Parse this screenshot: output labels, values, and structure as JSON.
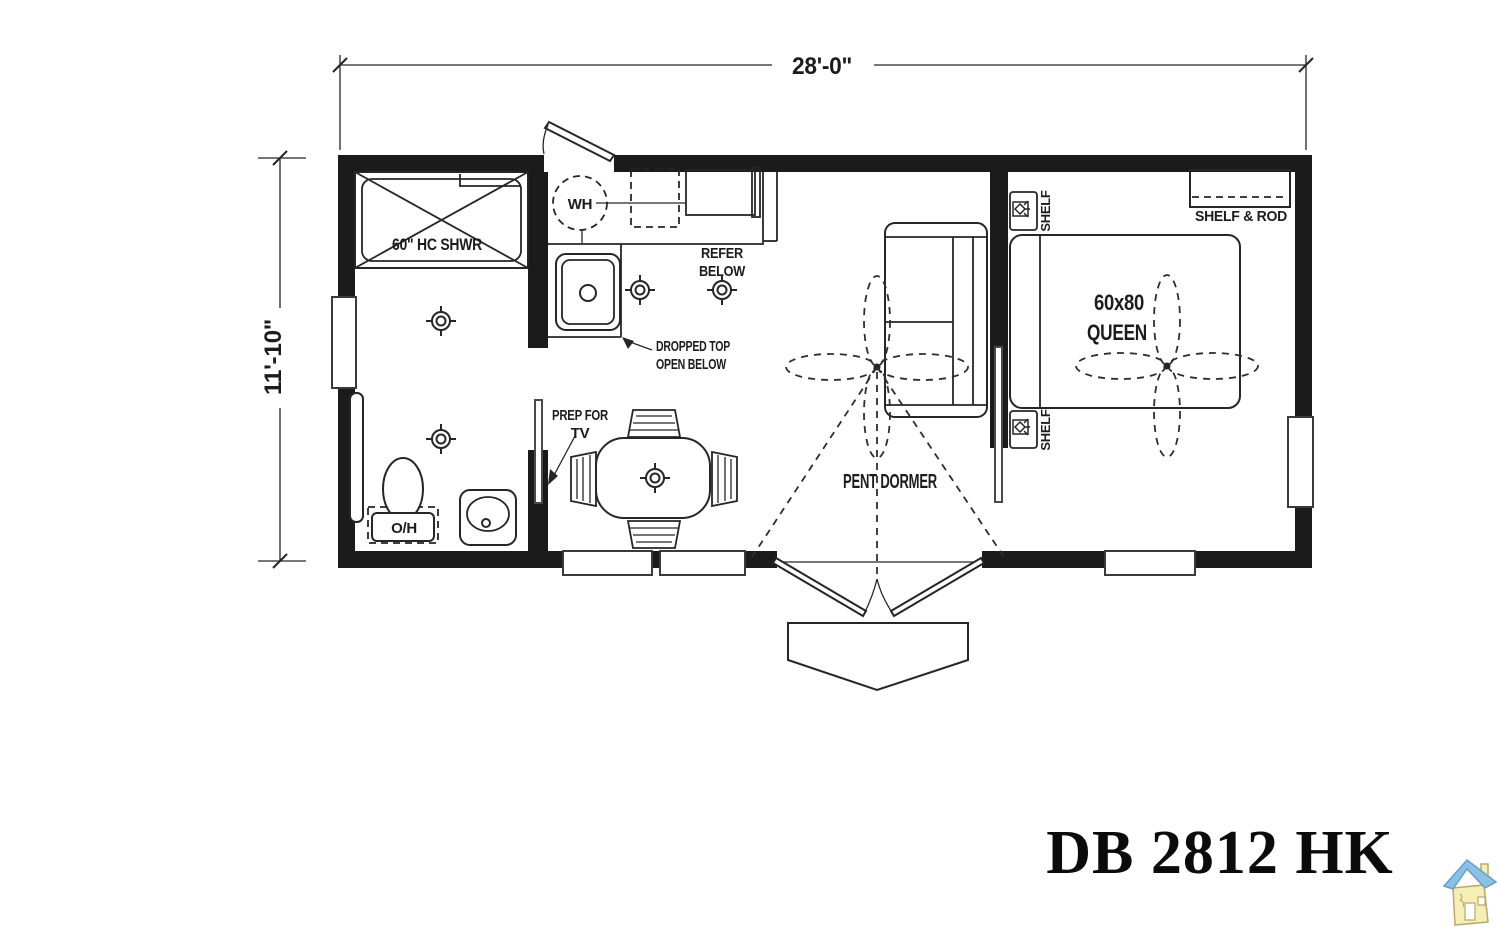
{
  "plan": {
    "dims": {
      "width_label": "28'-0\"",
      "height_label": "11'-10\""
    },
    "labels": {
      "shower": "60\" HC SHWR",
      "water_heater": "WH",
      "refer_l1": "REFER",
      "refer_l2": "BELOW",
      "dropped_l1": "DROPPED TOP",
      "dropped_l2": "OPEN BELOW",
      "tv_l1": "PREP FOR",
      "tv_l2": "TV",
      "overhead": "O/H",
      "pent_dormer": "PENT DORMER",
      "bed_l1": "60x80",
      "bed_l2": "QUEEN",
      "shelf_rod": "SHELF & ROD",
      "shelf_upper": "SHELF",
      "shelf_lower": "SHELF"
    },
    "colors": {
      "line": "#262626",
      "wall": "#1b1b1b",
      "background": "#ffffff",
      "logo_roof": "#8ac1e6",
      "logo_body": "#f6efb5"
    }
  },
  "title": {
    "model": "DB 2812 HK"
  }
}
